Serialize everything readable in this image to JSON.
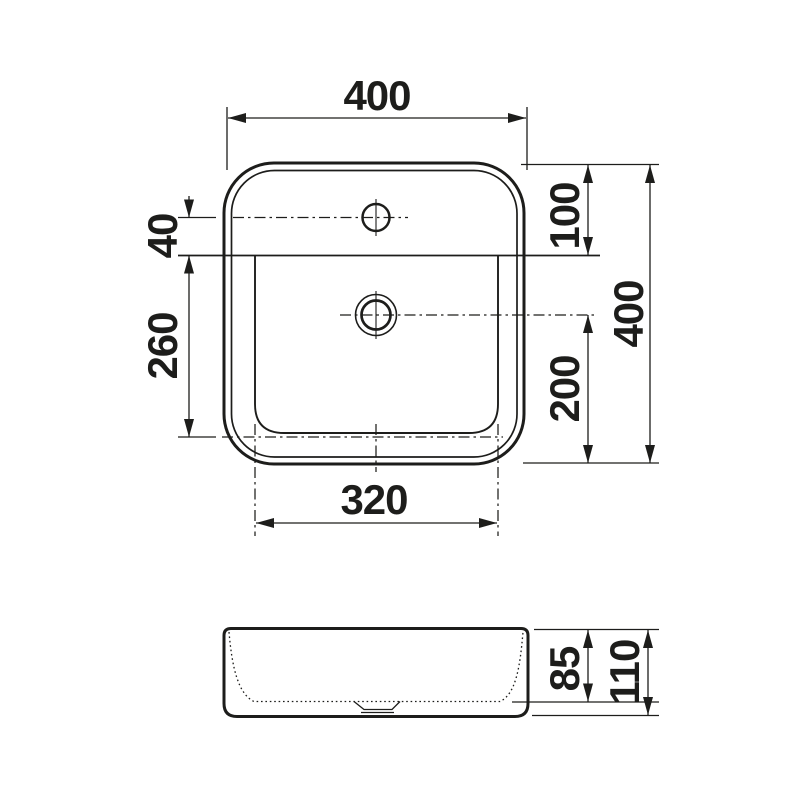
{
  "drawing": {
    "kind": "washbasin technical dimension drawing",
    "views": {
      "top": "top view",
      "side": "front section view"
    },
    "colors": {
      "line": "#1d1d1b",
      "background": "#ffffff"
    },
    "top_view": {
      "dims": {
        "overall_width": "400",
        "overall_depth": "400",
        "rear_edge_to_bowl": "100",
        "tap_center_to_bowl": "40",
        "bowl_length": "260",
        "drain_center_to_front": "200",
        "bowl_opening_width": "320"
      }
    },
    "side_view": {
      "dims": {
        "inner_depth": "85",
        "total_height": "110"
      }
    }
  }
}
